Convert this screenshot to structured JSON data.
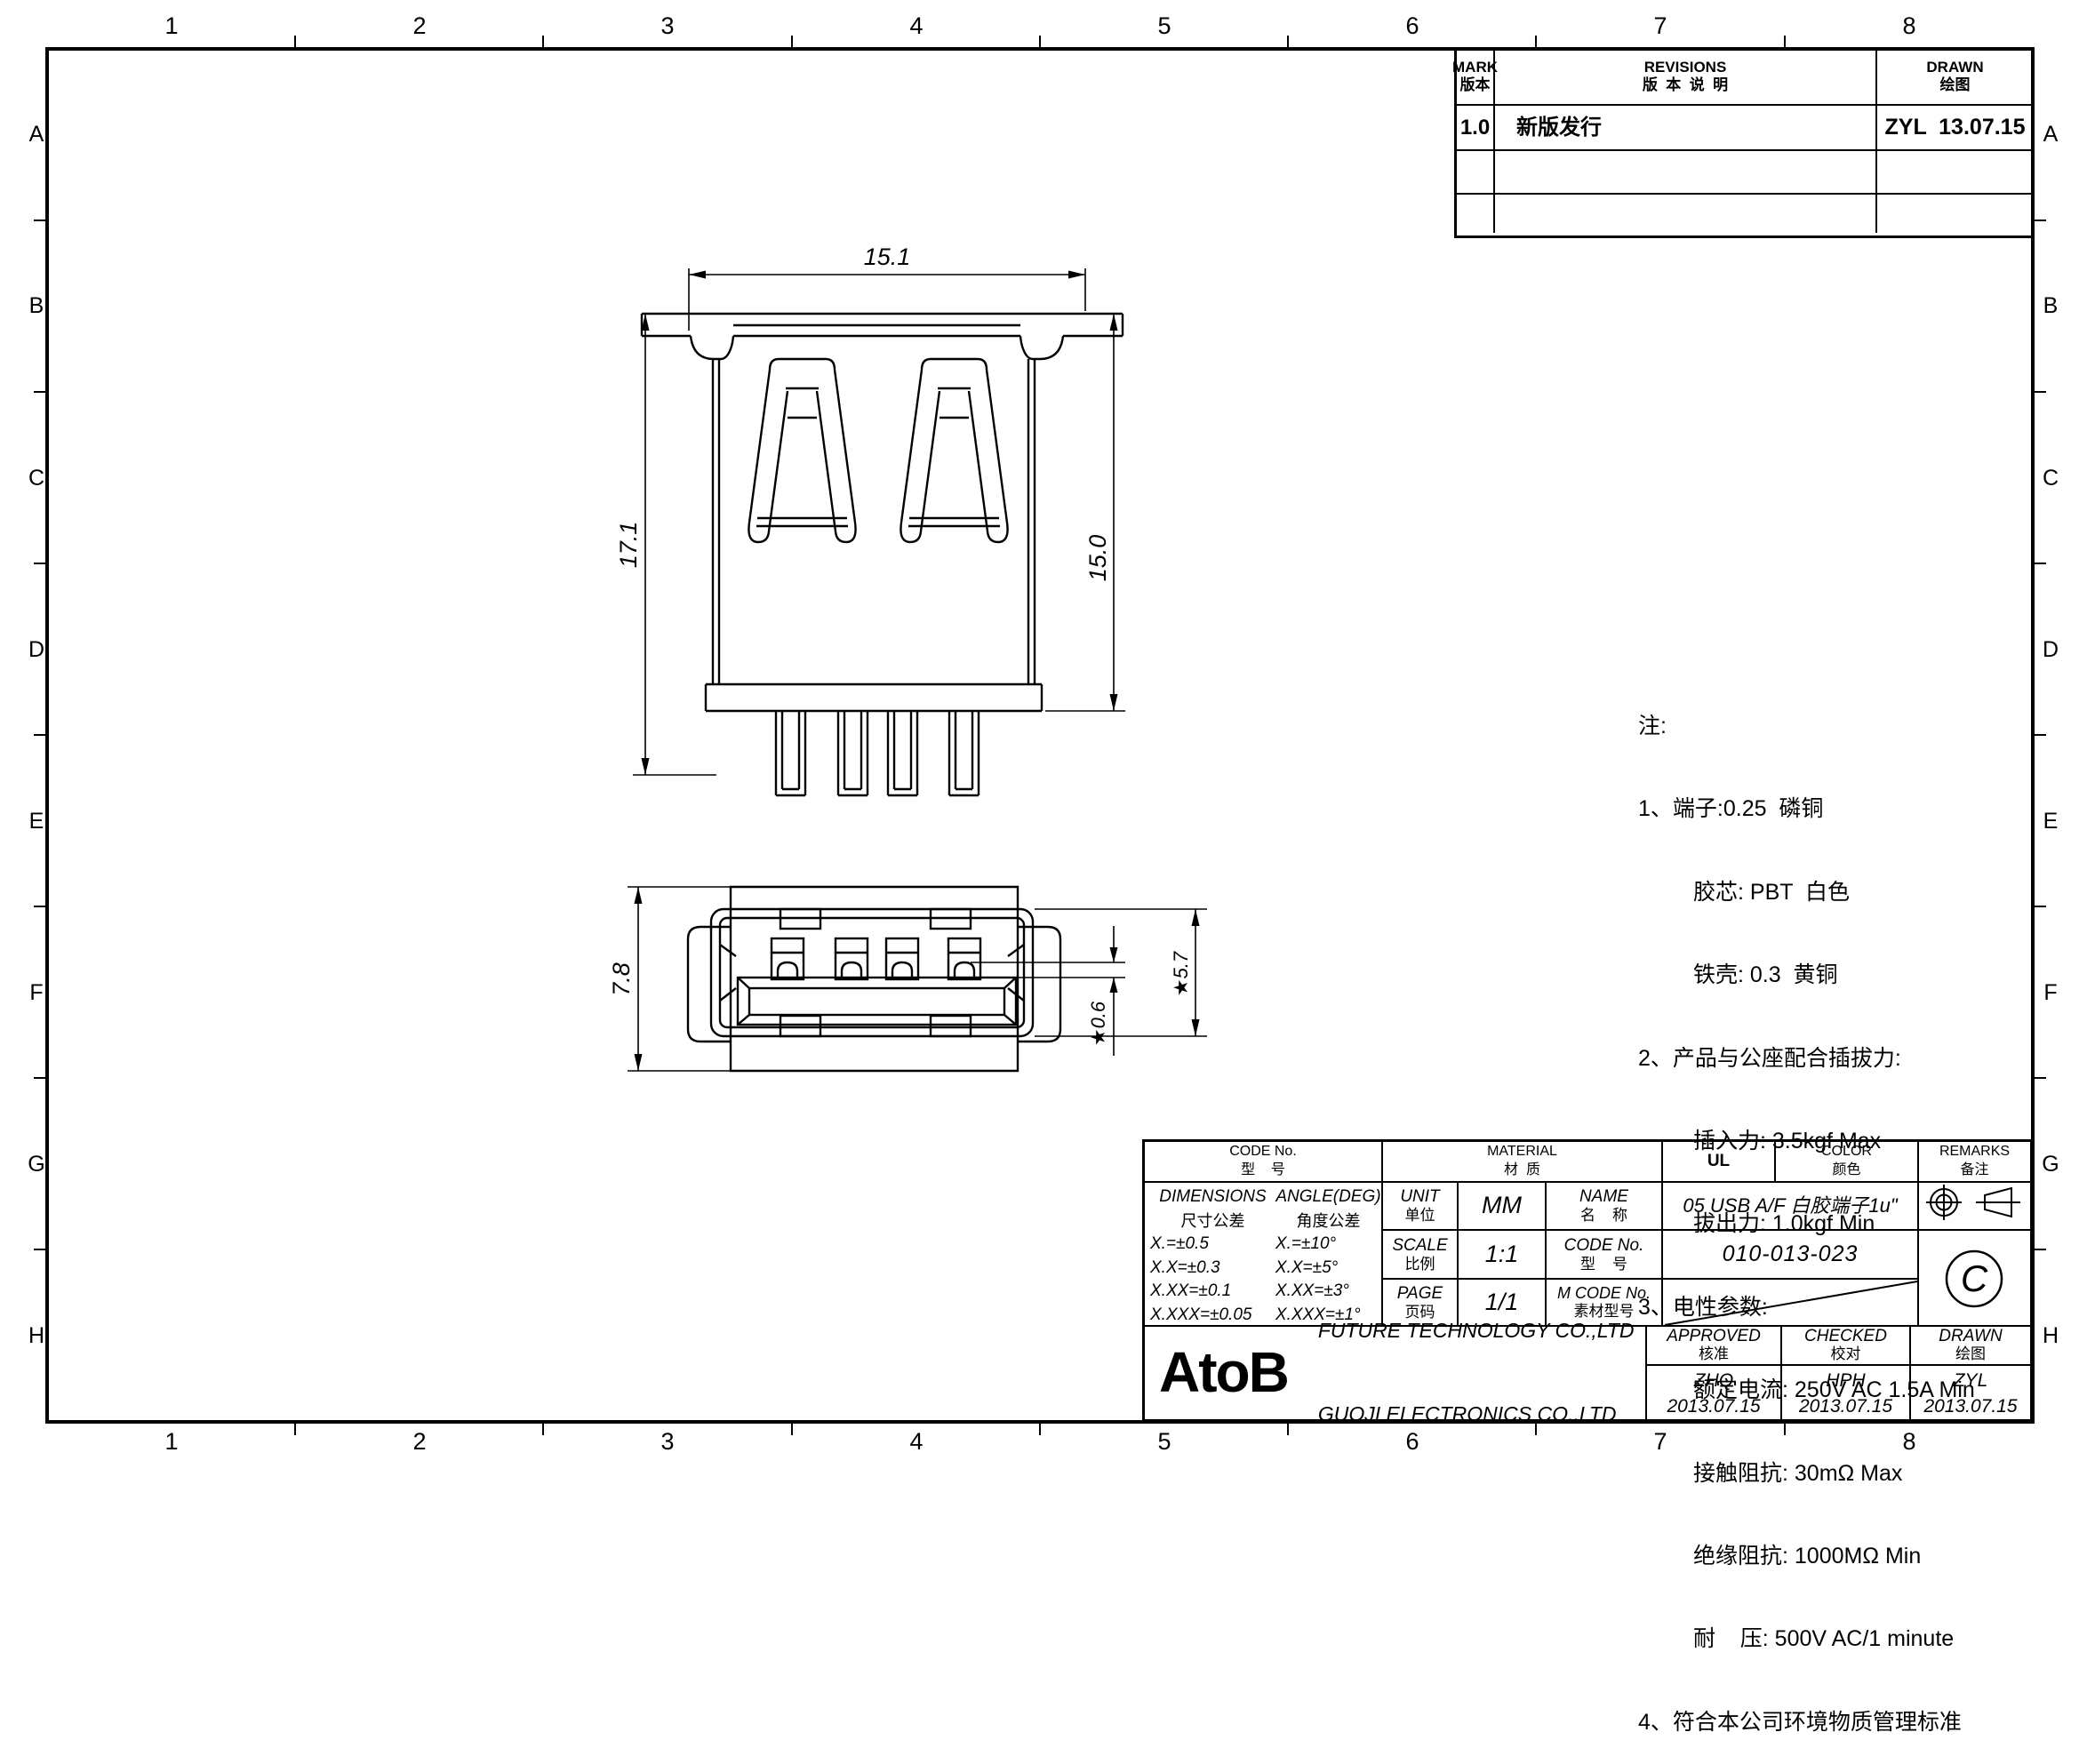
{
  "page": {
    "zone_numbers": [
      "1",
      "2",
      "3",
      "4",
      "5",
      "6",
      "7",
      "8"
    ],
    "zone_letters": [
      "A",
      "B",
      "C",
      "D",
      "E",
      "F",
      "G",
      "H"
    ],
    "colors": {
      "line": "#000000",
      "background": "#ffffff"
    }
  },
  "revisions_table": {
    "mark_label_en": "MARK",
    "mark_label_cn": "版本",
    "revisions_label_en": "REVISIONS",
    "revisions_label_cn": "版  本  说  明",
    "drawn_label_en": "DRAWN",
    "drawn_label_cn": "绘图",
    "rows": [
      {
        "mark": "1.0",
        "description": "新版发行",
        "drawn": "ZYL  13.07.15"
      }
    ]
  },
  "notes": {
    "lines": [
      "注:",
      "1、端子:0.25  磷铜",
      "胶芯: PBT  白色",
      "铁壳: 0.3  黄铜",
      "2、产品与公座配合插拔力:",
      "插入力: 3.5kgf Max",
      "拔出力: 1.0kgf Min",
      "3、电性参数:",
      "额定电流: 250V AC 1.5A Min",
      "接触阻抗: 30mΩ Max",
      "绝缘阻抗: 1000MΩ Min",
      "耐    压: 500V AC/1 minute",
      "4、符合本公司环境物质管理标准"
    ]
  },
  "drawing": {
    "front_view": {
      "dim_width": "15.1",
      "dim_height_total": "17.1",
      "dim_height_shell": "15.0"
    },
    "face_view": {
      "dim_height_body": "7.8",
      "dim_gap": "★0.6",
      "dim_opening": "★5.7"
    }
  },
  "title_block": {
    "code_header": {
      "en": "CODE No.",
      "cn": "型    号"
    },
    "material_header": {
      "en": "MATERIAL",
      "cn": "材  质"
    },
    "ul_header": "UL",
    "color_header": {
      "en": "COLOR",
      "cn": "颜色"
    },
    "remarks_header": {
      "en": "REMARKS",
      "cn": "备注"
    },
    "tolerances": {
      "dim_title_en": "DIMENSIONS",
      "dim_title_cn": "尺寸公差",
      "dims": [
        "X.=±0.5",
        "X.X=±0.3",
        "X.XX=±0.1",
        "X.XXX=±0.05"
      ],
      "angle_title_en": "ANGLE(DEG)",
      "angle_title_cn": "角度公差",
      "angles": [
        "X.=±10°",
        "X.X=±5°",
        "X.XX=±3°",
        "X.XXX=±1°"
      ]
    },
    "unit": {
      "en": "UNIT",
      "cn": "单位",
      "value": "MM"
    },
    "scale": {
      "en": "SCALE",
      "cn": "比例",
      "value": "1:1"
    },
    "page": {
      "en": "PAGE",
      "cn": "页码",
      "value": "1/1"
    },
    "name": {
      "en": "NAME",
      "cn": "名    称",
      "value": "05 USB A/F 白胶端子1u\""
    },
    "code": {
      "en": "CODE No.",
      "cn": "型    号",
      "value": "010-013-023"
    },
    "mcode": {
      "en": "M CODE No.",
      "cn": "素材型号",
      "value": ""
    },
    "symbols": {
      "copyright": "C"
    },
    "logo": "AtoB",
    "company_line1": "FUTURE TECHNOLOGY CO.,LTD",
    "company_line2": "GUOJI ELECTRONICS CO.,LTD",
    "approved": {
      "en": "APPROVED",
      "cn": "核准",
      "name": "ZHQ",
      "date": "2013.07.15"
    },
    "checked": {
      "en": "CHECKED",
      "cn": "校对",
      "name": "HPH",
      "date": "2013.07.15"
    },
    "drawn": {
      "en": "DRAWN",
      "cn": "绘图",
      "name": "ZYL",
      "date": "2013.07.15"
    }
  }
}
